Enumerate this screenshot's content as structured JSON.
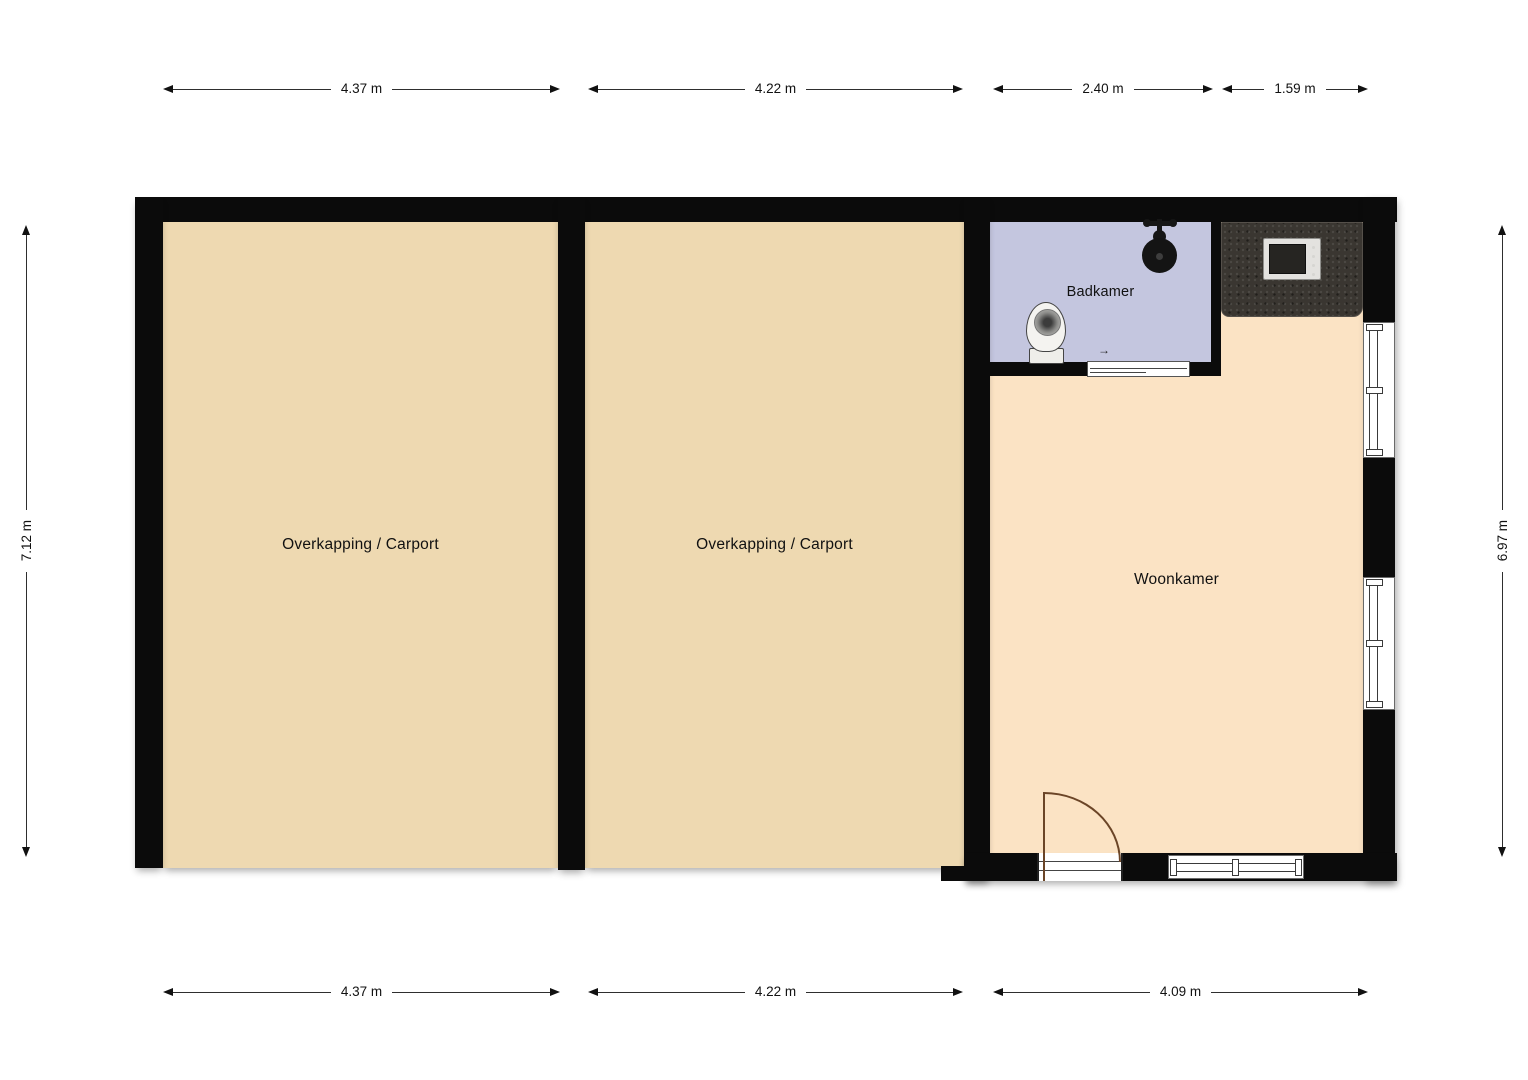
{
  "colors": {
    "background": "#ffffff",
    "wall": "#0b0b0b",
    "carport_floor": "#eed9b1",
    "woonkamer_floor": "#fbe3c4",
    "badkamer_floor": "#c4c6df",
    "counter": "#3a3631",
    "door_arc": "#6b4527"
  },
  "rooms": {
    "carport1": {
      "label": "Overkapping / Carport"
    },
    "carport2": {
      "label": "Overkapping / Carport"
    },
    "badkamer": {
      "label": "Badkamer"
    },
    "woonkamer": {
      "label": "Woonkamer"
    }
  },
  "dimensions": {
    "top": [
      {
        "label": "4.37 m"
      },
      {
        "label": "4.22 m"
      },
      {
        "label": "2.40 m"
      },
      {
        "label": "1.59 m"
      }
    ],
    "bottom": [
      {
        "label": "4.37 m"
      },
      {
        "label": "4.22 m"
      },
      {
        "label": "4.09 m"
      }
    ],
    "left": {
      "label": "7.12 m"
    },
    "right": {
      "label": "6.97 m"
    }
  },
  "fixtures": {
    "door_arrow": "→"
  }
}
